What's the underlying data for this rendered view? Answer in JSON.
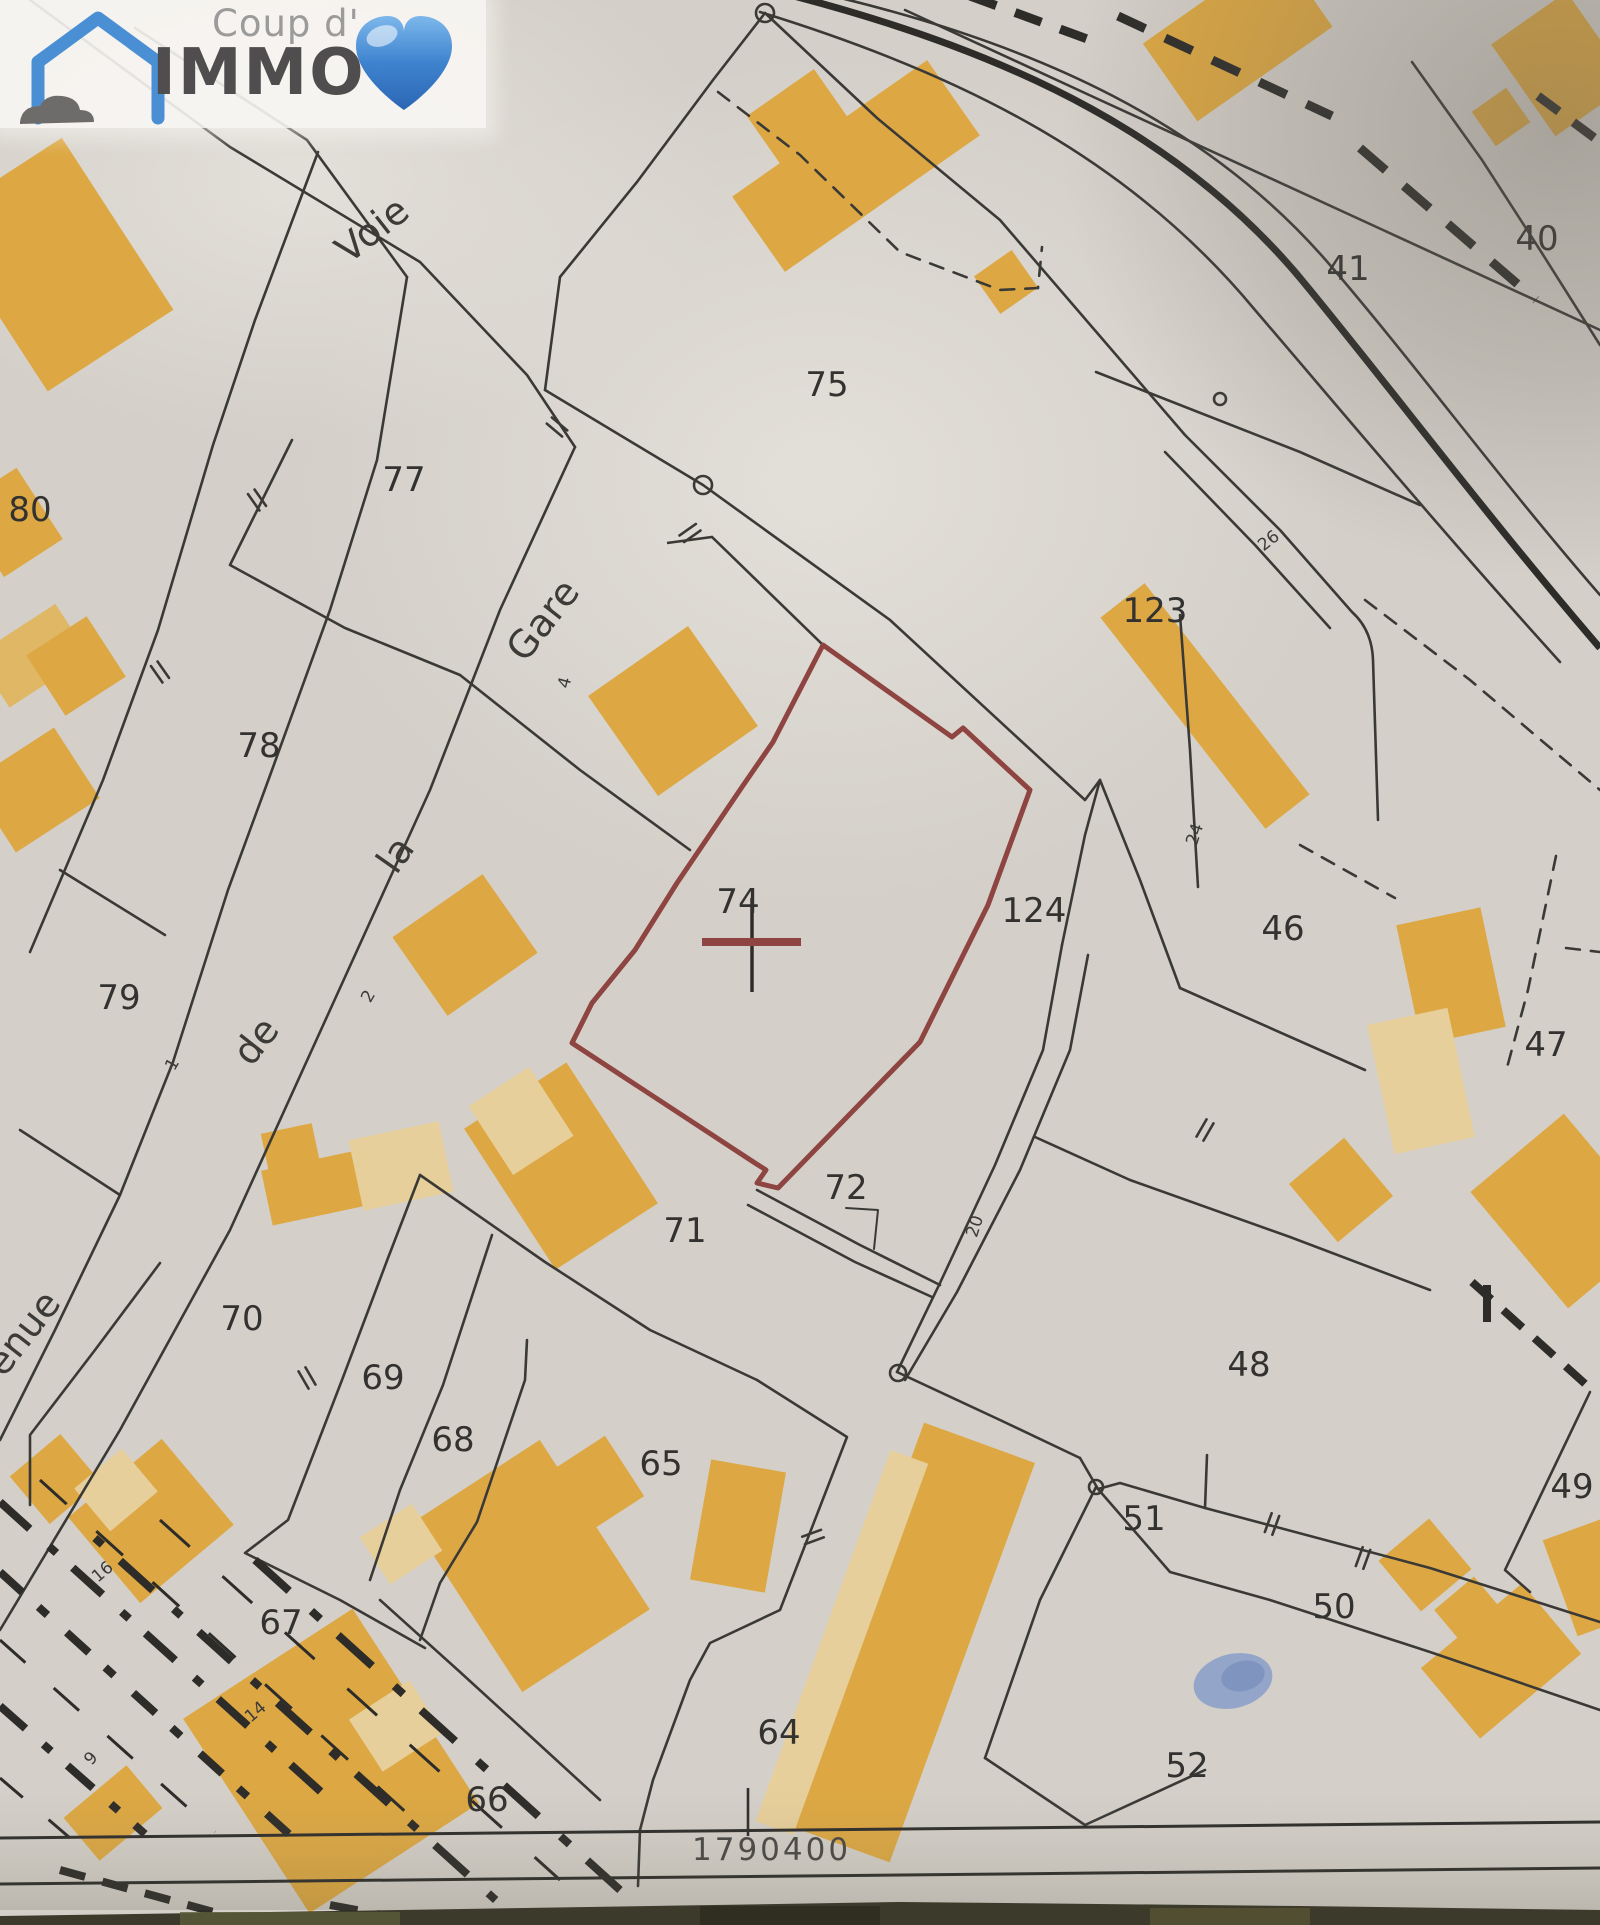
{
  "logo": {
    "brand_prefix": "Coup d'",
    "brand_name": "IMMO",
    "icons": [
      "house-icon",
      "cloud-icon",
      "heart-icon"
    ]
  },
  "map": {
    "type": "cadastral-plan-photo",
    "marked_parcel": {
      "id": "74",
      "outline_color": "#8e4440",
      "marker": "cross"
    },
    "coordinate_label": {
      "text": "1790400",
      "x": 747,
      "y": 1858
    },
    "parcel_labels": [
      {
        "id": "80",
        "x": 30,
        "y": 521
      },
      {
        "id": "77",
        "x": 404,
        "y": 491
      },
      {
        "id": "75",
        "x": 827,
        "y": 396
      },
      {
        "id": "41",
        "x": 1348,
        "y": 280
      },
      {
        "id": "40",
        "x": 1537,
        "y": 250
      },
      {
        "id": "123",
        "x": 1155,
        "y": 622
      },
      {
        "id": "78",
        "x": 259,
        "y": 757
      },
      {
        "id": "79",
        "x": 119,
        "y": 1009
      },
      {
        "id": "74",
        "x": 738,
        "y": 913
      },
      {
        "id": "124",
        "x": 1034,
        "y": 922
      },
      {
        "id": "46",
        "x": 1283,
        "y": 940
      },
      {
        "id": "47",
        "x": 1546,
        "y": 1056
      },
      {
        "id": "71",
        "x": 685,
        "y": 1242
      },
      {
        "id": "72",
        "x": 846,
        "y": 1199
      },
      {
        "id": "70",
        "x": 242,
        "y": 1330
      },
      {
        "id": "69",
        "x": 383,
        "y": 1389
      },
      {
        "id": "68",
        "x": 453,
        "y": 1451
      },
      {
        "id": "65",
        "x": 661,
        "y": 1475
      },
      {
        "id": "48",
        "x": 1249,
        "y": 1376
      },
      {
        "id": "49",
        "x": 1572,
        "y": 1498
      },
      {
        "id": "51",
        "x": 1144,
        "y": 1530
      },
      {
        "id": "50",
        "x": 1334,
        "y": 1618
      },
      {
        "id": "67",
        "x": 281,
        "y": 1634
      },
      {
        "id": "64",
        "x": 779,
        "y": 1744
      },
      {
        "id": "66",
        "x": 487,
        "y": 1811
      },
      {
        "id": "52",
        "x": 1187,
        "y": 1777
      }
    ],
    "road_name_words": [
      {
        "text": "Voie",
        "x": 380,
        "y": 240,
        "rot": -38
      },
      {
        "text": "Gare",
        "x": 553,
        "y": 628,
        "rot": -52
      },
      {
        "text": "la",
        "x": 406,
        "y": 862,
        "rot": -55
      },
      {
        "text": "de",
        "x": 266,
        "y": 1049,
        "rot": -52
      },
      {
        "text": "venue",
        "x": 26,
        "y": 1350,
        "rot": -52
      }
    ],
    "lot_numbers": [
      {
        "text": "4",
        "x": 570,
        "y": 684,
        "rot": -75
      },
      {
        "text": "2",
        "x": 373,
        "y": 999,
        "rot": -60
      },
      {
        "text": "1",
        "x": 177,
        "y": 1067,
        "rot": -60
      },
      {
        "text": "26",
        "x": 1272,
        "y": 545,
        "rot": -38
      },
      {
        "text": "24",
        "x": 1200,
        "y": 836,
        "rot": -72
      },
      {
        "text": "20",
        "x": 980,
        "y": 1228,
        "rot": -72
      },
      {
        "text": "16",
        "x": 106,
        "y": 1576,
        "rot": -40
      },
      {
        "text": "14",
        "x": 259,
        "y": 1716,
        "rot": -40
      },
      {
        "text": "9",
        "x": 95,
        "y": 1762,
        "rot": -48
      }
    ],
    "colors": {
      "paper": "#d4d0c9",
      "boundary_line": "#3a3936",
      "building_fill": "#dda843",
      "building_fill_light": "#e7cf9b",
      "marked_parcel_outline": "#8e4440",
      "railway": "#2d2c29",
      "water_feature": "#93a5c9",
      "photo_background_edge": "#3c3a2b"
    }
  }
}
